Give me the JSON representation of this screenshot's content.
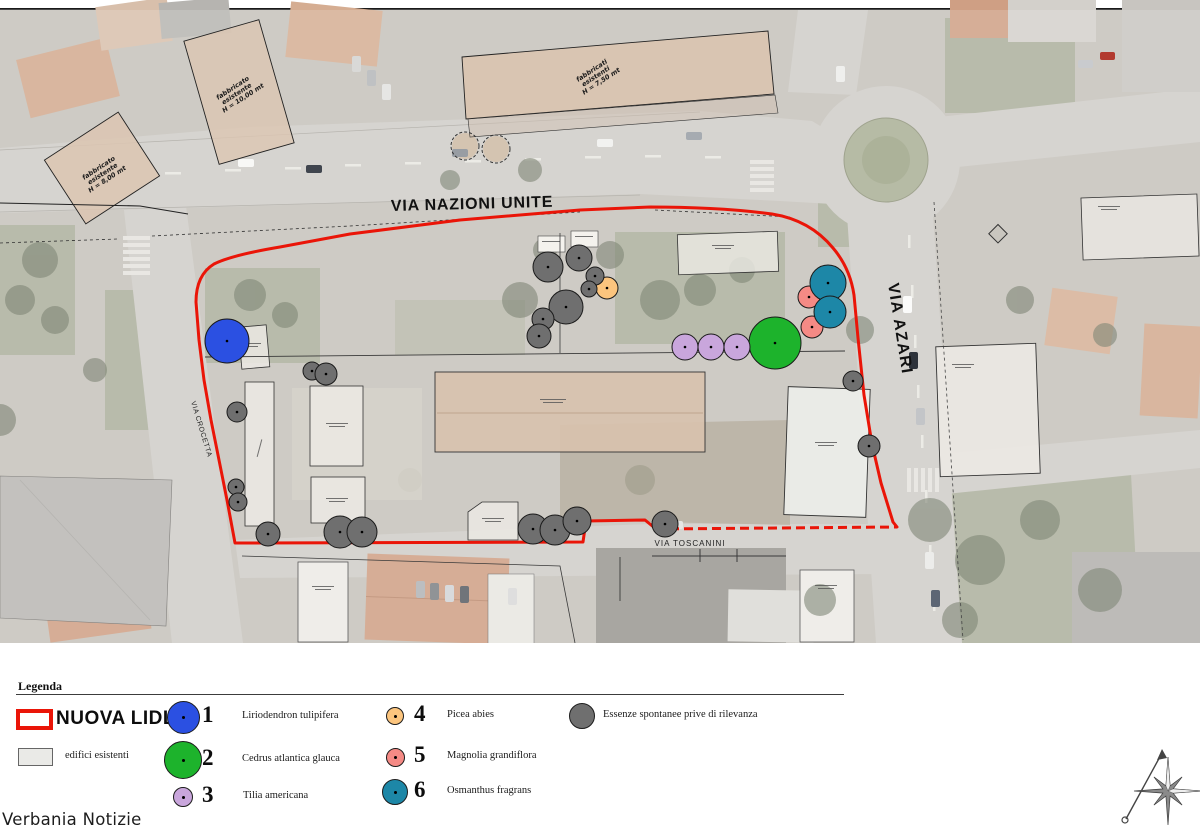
{
  "map": {
    "streets": {
      "via_nazioni_unite": "VIA NAZIONI UNITE",
      "via_azari": "VIA AZARI",
      "via_toscanini": "VIA TOSCANINI",
      "via_crocetta": "VIA CROCETTA"
    },
    "building_labels": {
      "left": [
        "fabbricato",
        "esistente",
        "H = 8,00 mt"
      ],
      "top": [
        "fabbricato",
        "esistente",
        "H = 10,00 mt"
      ],
      "center": [
        "fabbricati",
        "esistenti",
        "H = 7,50 mt"
      ]
    },
    "markers": {
      "liriodendron": [
        [
          227,
          341,
          22
        ]
      ],
      "cedrus": [
        [
          775,
          343,
          26
        ]
      ],
      "tilia": [
        [
          685,
          347,
          13
        ],
        [
          711,
          347,
          13
        ],
        [
          737,
          347,
          13
        ]
      ],
      "picea": [
        [
          607,
          288,
          11
        ]
      ],
      "magnolia": [
        [
          809,
          297,
          11
        ],
        [
          812,
          327,
          11
        ]
      ],
      "osmanthus": [
        [
          828,
          283,
          18
        ],
        [
          830,
          312,
          16
        ]
      ],
      "spontanee": [
        [
          548,
          267,
          15
        ],
        [
          579,
          258,
          13
        ],
        [
          595,
          276,
          9
        ],
        [
          589,
          289,
          8
        ],
        [
          566,
          307,
          17
        ],
        [
          543,
          319,
          11
        ],
        [
          539,
          336,
          12
        ],
        [
          312,
          371,
          9
        ],
        [
          326,
          374,
          11
        ],
        [
          237,
          412,
          10
        ],
        [
          236,
          487,
          8
        ],
        [
          238,
          502,
          9
        ],
        [
          268,
          534,
          12
        ],
        [
          340,
          532,
          16
        ],
        [
          362,
          532,
          15
        ],
        [
          533,
          529,
          15
        ],
        [
          555,
          530,
          15
        ],
        [
          577,
          521,
          14
        ],
        [
          665,
          524,
          13
        ],
        [
          853,
          381,
          10
        ],
        [
          869,
          446,
          11
        ]
      ]
    },
    "dashed_tree_outlines": [
      [
        465,
        146,
        14
      ],
      [
        496,
        149,
        14
      ]
    ]
  },
  "legend": {
    "title": "Legenda",
    "site_label": "NUOVA LIDL",
    "site_color": "#ea1508",
    "buildings_label": "edifici esistenti",
    "buildings_color": "#eaeae7",
    "trees": [
      {
        "key": "liriodendron",
        "num": "1",
        "name": "Liriodendron tulipifera",
        "color": "#2b50e2"
      },
      {
        "key": "cedrus",
        "num": "2",
        "name": "Cedrus atlantica glauca",
        "color": "#1db32c"
      },
      {
        "key": "tilia",
        "num": "3",
        "name": "Tilia americana",
        "color": "#c9a6dc"
      },
      {
        "key": "picea",
        "num": "4",
        "name": "Picea abies",
        "color": "#fcc57e"
      },
      {
        "key": "magnolia",
        "num": "5",
        "name": "Magnolia grandiflora",
        "color": "#f58a85"
      },
      {
        "key": "osmanthus",
        "num": "6",
        "name": "Osmanthus fragrans",
        "color": "#1d87a7"
      }
    ],
    "spontaneous": {
      "name": "Essenze spontanee prive di rilevanza",
      "color": "#6f6f6f"
    }
  },
  "watermark": "Verbania Notizie"
}
